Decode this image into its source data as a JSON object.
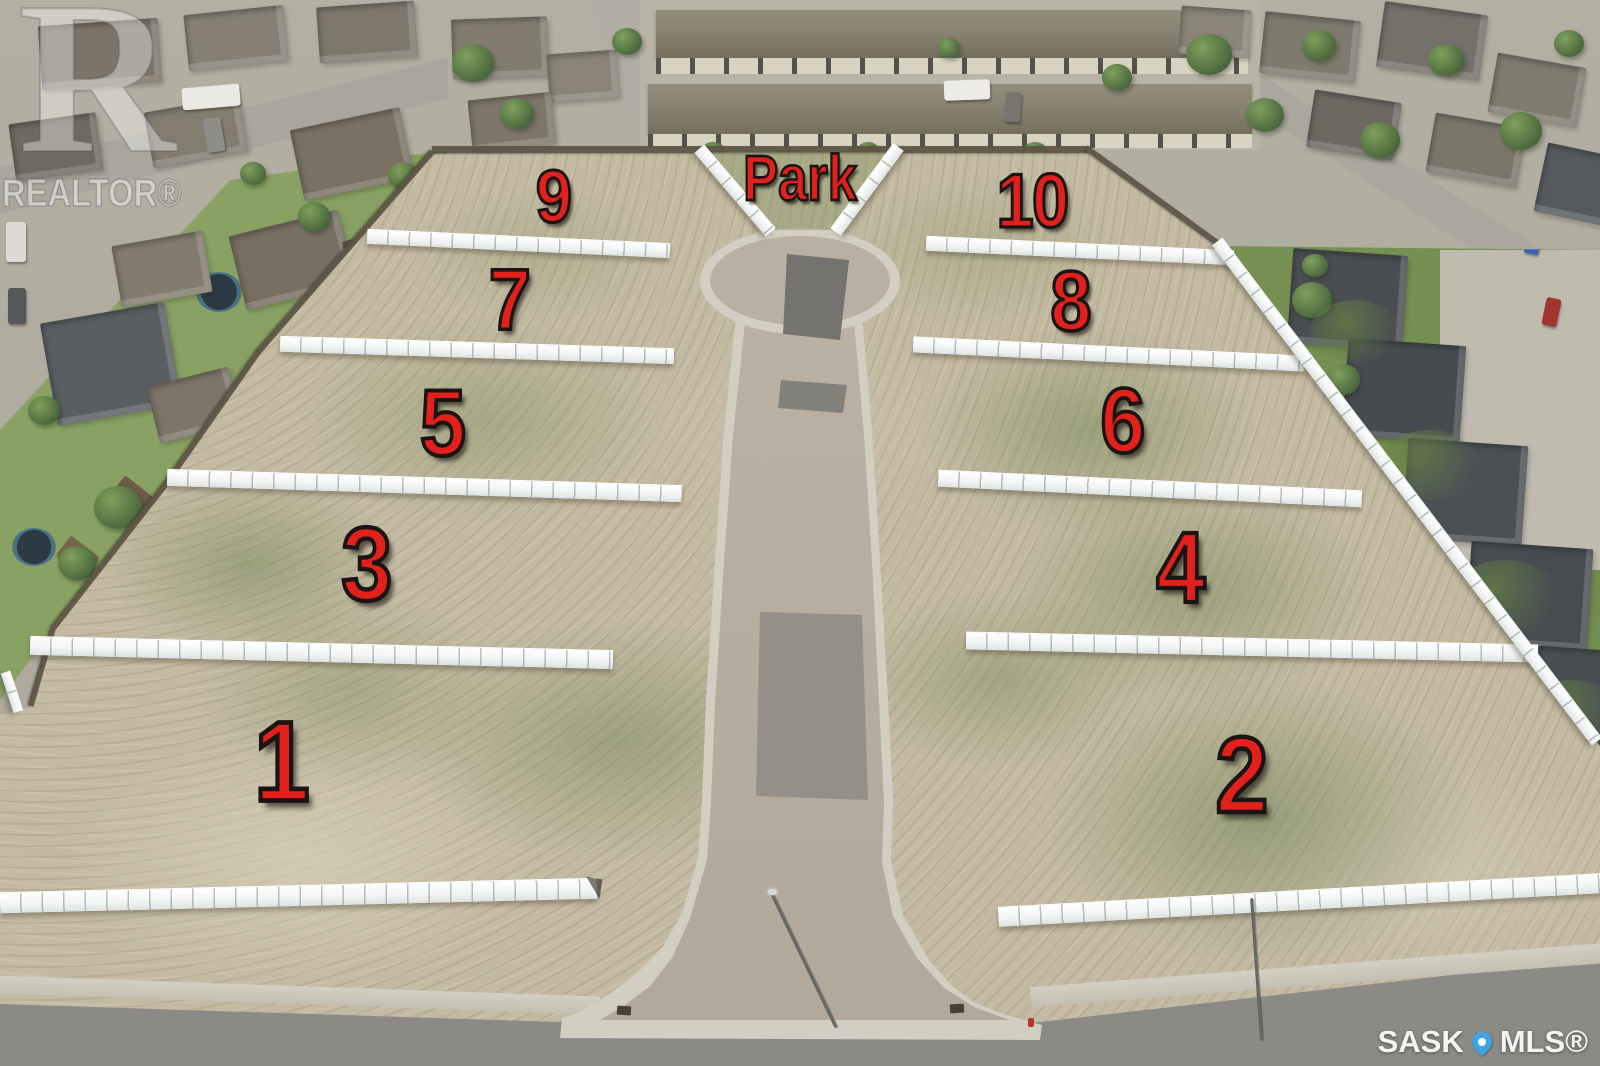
{
  "overlay": {
    "park_label": "Park",
    "lot_numbers": [
      "1",
      "2",
      "3",
      "4",
      "5",
      "6",
      "7",
      "8",
      "9",
      "10"
    ],
    "number_color": "#e2211c",
    "number_outline_color": "#1a1512"
  },
  "watermarks": {
    "realtor": {
      "symbol": "R",
      "label": "REALTOR®"
    },
    "mls": {
      "prefix": "SASK",
      "suffix": "MLS®",
      "pin_color": "#3fa5e0"
    }
  },
  "scene_colors": {
    "fence_white": "#f3f6f5",
    "dirt": "#c4b9a2",
    "road": "#8f8e8b"
  }
}
